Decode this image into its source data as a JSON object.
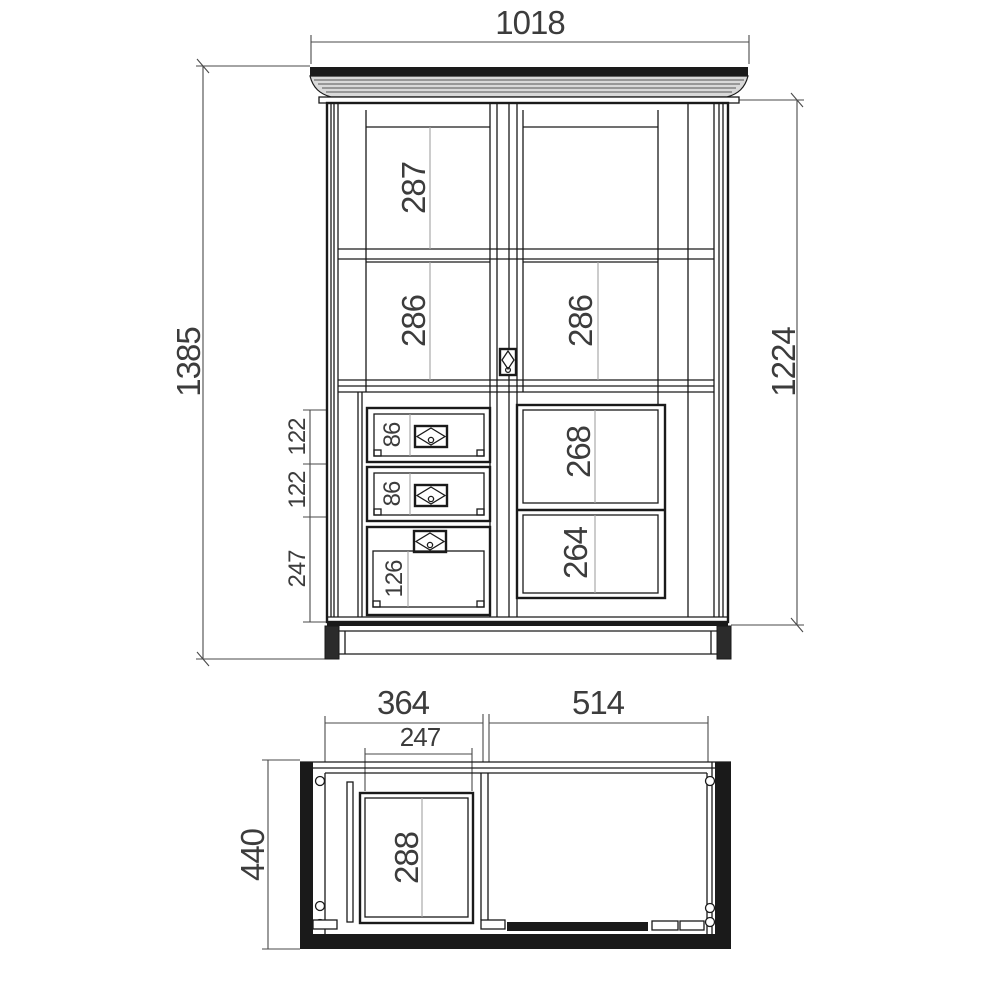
{
  "drawing": {
    "front": {
      "overall_width": "1018",
      "overall_height": "1385",
      "body_height": "1224",
      "top_shelf": "287",
      "mid_shelf_left": "286",
      "mid_shelf_right": "286",
      "right_panel_upper": "268",
      "right_panel_lower": "264",
      "drawer_pitch_1": "122",
      "drawer_pitch_2": "122",
      "lower_section_height": "247",
      "drawer_front_1": "86",
      "drawer_front_2": "86",
      "lower_door_panel": "126"
    },
    "plan": {
      "left_compartment_width": "364",
      "right_compartment_width": "514",
      "drawer_width": "247",
      "depth": "440",
      "drawer_depth": "288"
    },
    "colors": {
      "line": "#1a1a1a",
      "dim": "#4a4a4a",
      "aux": "#a3a3a3",
      "text": "#3c3c3c",
      "paper": "#ffffff"
    }
  }
}
